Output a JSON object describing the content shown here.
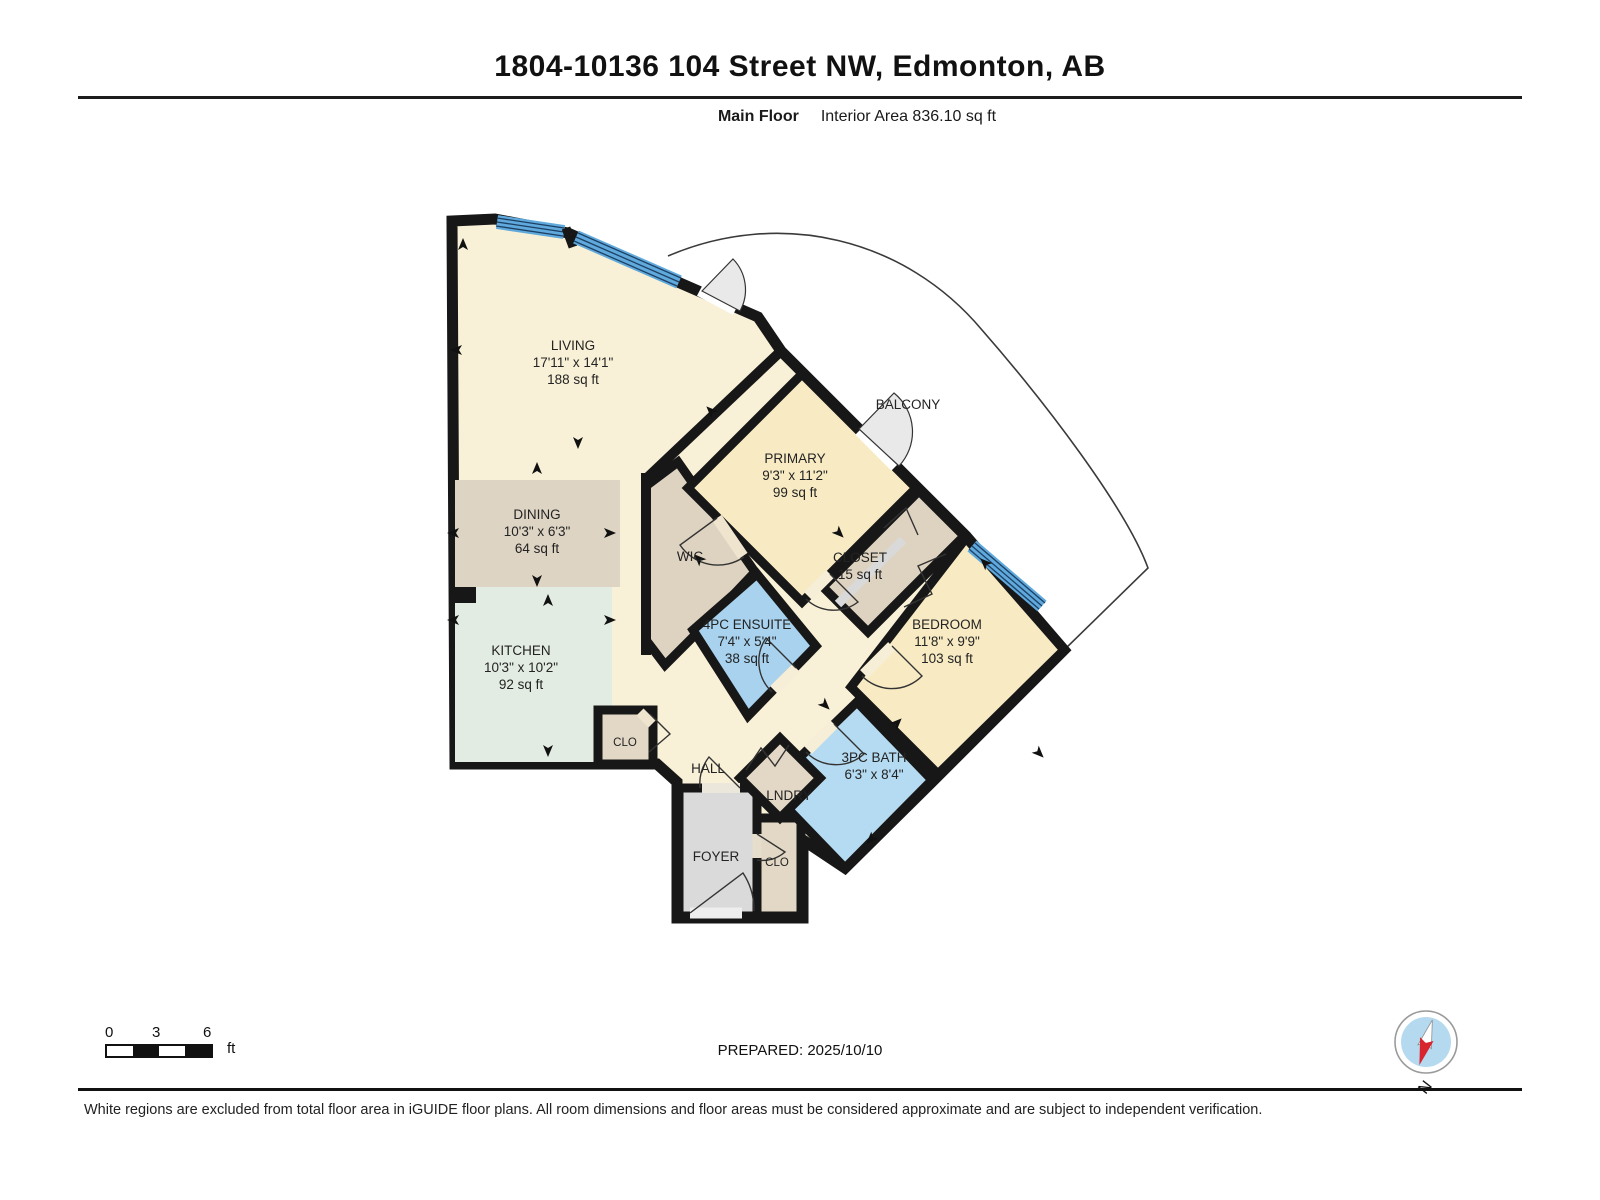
{
  "header": {
    "title": "1804-10136 104 Street NW, Edmonton, AB",
    "floor_label": "Main Floor",
    "area_label": "Interior Area 836.10 sq ft"
  },
  "rooms": {
    "living": {
      "name": "LIVING",
      "dims": "17'11\" x 14'1\"",
      "area": "188 sq ft"
    },
    "dining": {
      "name": "DINING",
      "dims": "10'3\" x 6'3\"",
      "area": "64 sq ft"
    },
    "kitchen": {
      "name": "KITCHEN",
      "dims": "10'3\" x 10'2\"",
      "area": "92 sq ft"
    },
    "primary": {
      "name": "PRIMARY",
      "dims": "9'3\" x 11'2\"",
      "area": "99 sq ft"
    },
    "wic": {
      "name": "WIC"
    },
    "ensuite": {
      "name": "4PC ENSUITE",
      "dims": "7'4\" x 5'4\"",
      "area": "38 sq ft"
    },
    "closet": {
      "name": "CLOSET",
      "area": "15 sq ft"
    },
    "bedroom": {
      "name": "BEDROOM",
      "dims": "11'8\" x 9'9\"",
      "area": "103 sq ft"
    },
    "bath": {
      "name": "3PC BATH",
      "dims": "6'3\" x 8'4\""
    },
    "laundry": {
      "name": "LNDRY"
    },
    "hall": {
      "name": "HALL"
    },
    "foyer": {
      "name": "FOYER"
    },
    "closet_kitchen": {
      "name": "CLO"
    },
    "closet_foyer": {
      "name": "CLO"
    },
    "balcony": {
      "name": "BALCONY"
    }
  },
  "footer": {
    "scale_ticks": [
      "0",
      "3",
      "6"
    ],
    "scale_unit": "ft",
    "prepared": "PREPARED: 2025/10/10",
    "compass_label": "N",
    "disclaimer": "White regions are excluded from total floor area in iGUIDE floor plans. All room dimensions and floor areas must be considered approximate and are subject to independent verification."
  },
  "colors": {
    "wall": "#171717",
    "cream": "#f9f1d7",
    "room_tan": "#f8ebc4",
    "dining_tan": "#ddd4c3",
    "closet_tan": "#ded3c0",
    "kitchen_mint": "#e3ece2",
    "ensuite_blue": "#a8d2ee",
    "bath_blue": "#b5dbf2",
    "window_blue": "#5fa9dc",
    "foyer_gray": "#dadada"
  }
}
